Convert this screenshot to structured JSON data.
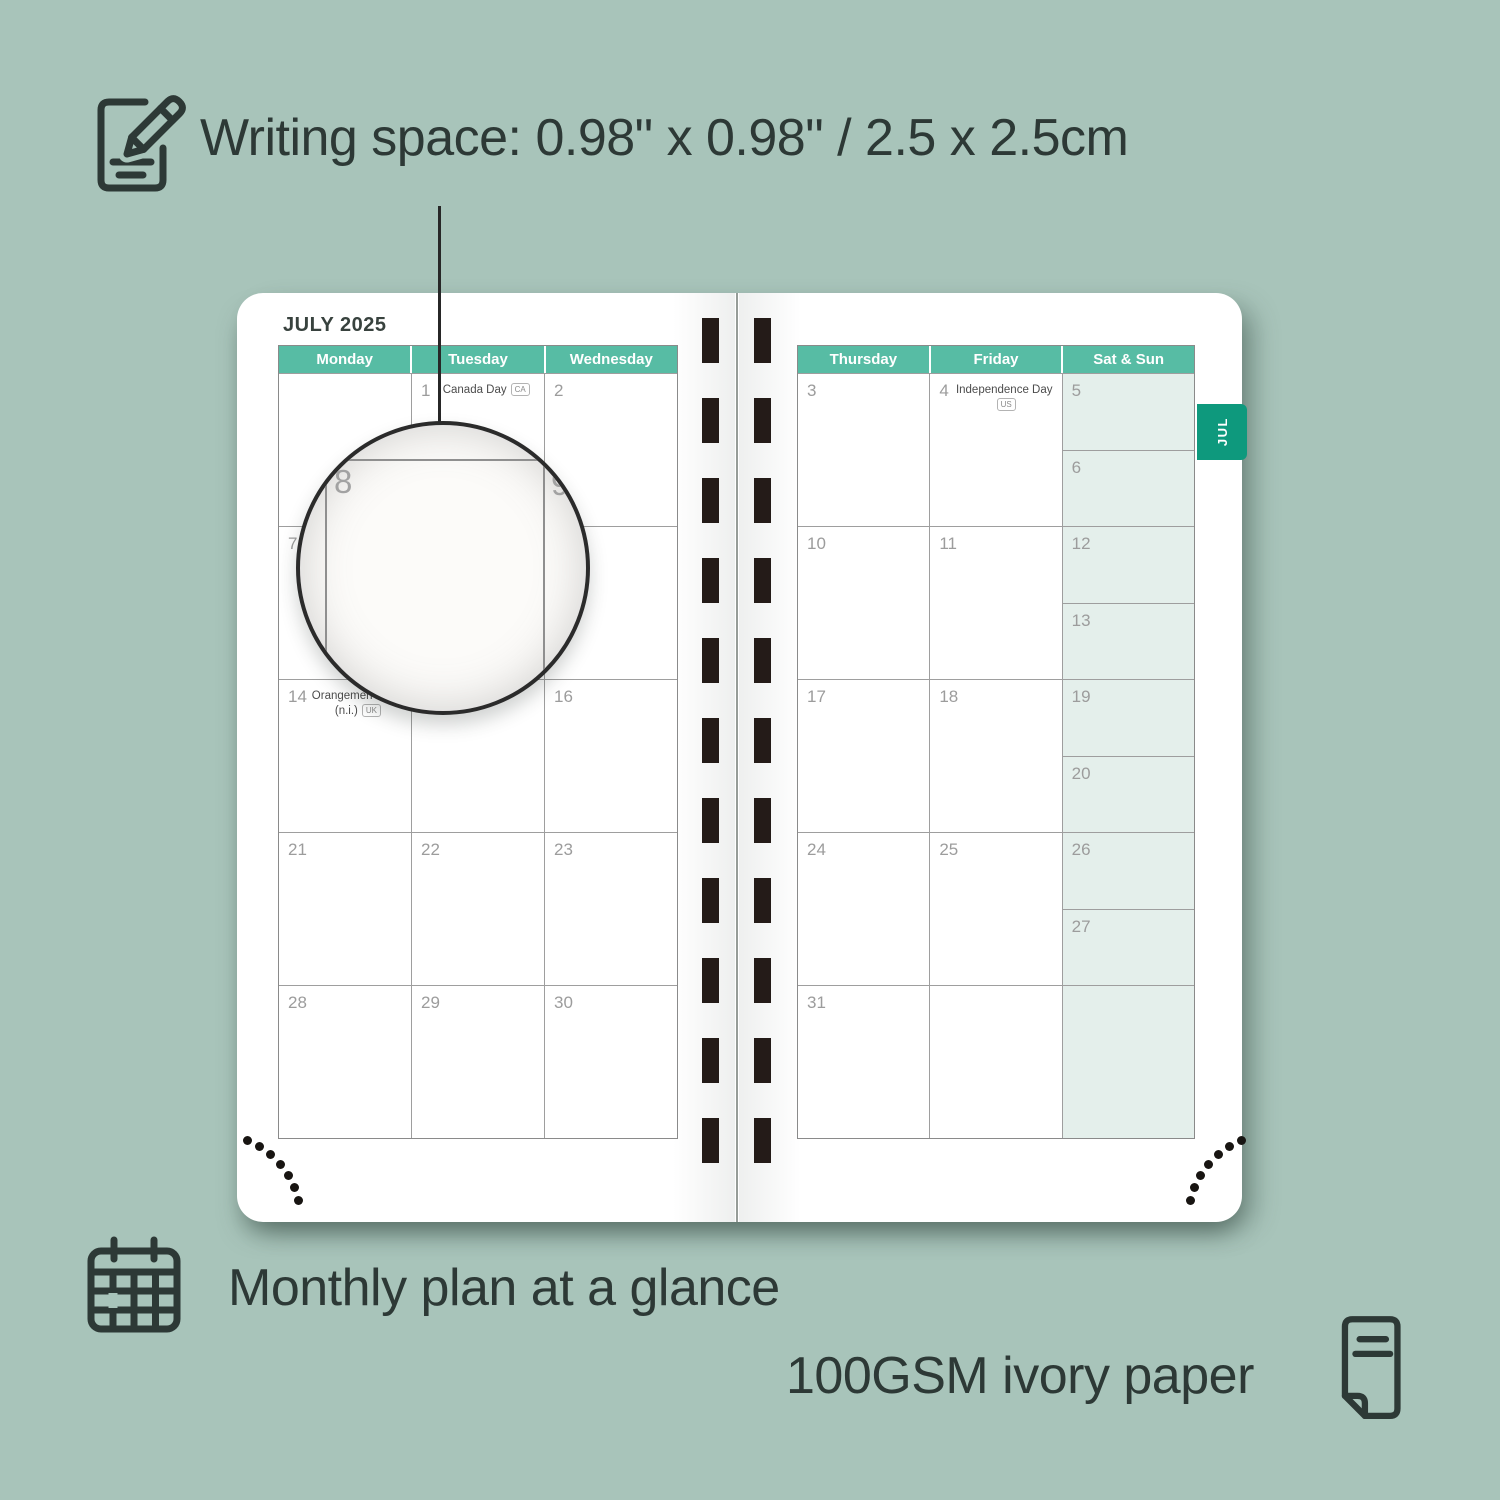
{
  "annotations": {
    "writing_space": "Writing space: 0.98\" x 0.98\" / 2.5 x 2.5cm",
    "monthly_plan": "Monthly plan at a glance",
    "paper": "100GSM ivory paper"
  },
  "planner": {
    "month_title": "JULY 2025",
    "tab_label": "JUL",
    "magnifier": {
      "cell_number": "8",
      "adjacent_number": "9"
    },
    "left_page": {
      "headers": [
        "Monday",
        "Tuesday",
        "Wednesday"
      ],
      "rows": [
        [
          {
            "n": ""
          },
          {
            "n": "1",
            "holiday": {
              "name": "Canada Day",
              "badge": "CA"
            }
          },
          {
            "n": "2"
          }
        ],
        [
          {
            "n": "7"
          },
          {
            "n": "8"
          },
          {
            "n": "9"
          }
        ],
        [
          {
            "n": "14",
            "holiday": {
              "name": "Orangemen's Day",
              "name2": "(n.i.)",
              "badge": "UK"
            }
          },
          {
            "n": "15"
          },
          {
            "n": "16"
          }
        ],
        [
          {
            "n": "21"
          },
          {
            "n": "22"
          },
          {
            "n": "23"
          }
        ],
        [
          {
            "n": "28"
          },
          {
            "n": "29"
          },
          {
            "n": "30"
          }
        ]
      ]
    },
    "right_page": {
      "headers": [
        "Thursday",
        "Friday",
        "Sat & Sun"
      ],
      "rows": [
        [
          {
            "n": "3"
          },
          {
            "n": "4",
            "holiday": {
              "name": "Independence Day",
              "badge": "US"
            }
          },
          {
            "split": [
              {
                "n": "5"
              },
              {
                "n": "6"
              }
            ]
          }
        ],
        [
          {
            "n": "10"
          },
          {
            "n": "11"
          },
          {
            "split": [
              {
                "n": "12"
              },
              {
                "n": "13"
              }
            ]
          }
        ],
        [
          {
            "n": "17"
          },
          {
            "n": "18"
          },
          {
            "split": [
              {
                "n": "19"
              },
              {
                "n": "20"
              }
            ]
          }
        ],
        [
          {
            "n": "24"
          },
          {
            "n": "25"
          },
          {
            "split": [
              {
                "n": "26"
              },
              {
                "n": "27"
              }
            ]
          }
        ],
        [
          {
            "n": "31"
          },
          {
            "n": ""
          },
          {
            "shaded": true,
            "n": ""
          }
        ]
      ]
    }
  },
  "colors": {
    "background": "#a8c4ba",
    "header_teal": "#57bca4",
    "tab_teal": "#0e997d",
    "weekend_fill": "#e4efeb",
    "ink": "#2d3936",
    "binding": "#241b18"
  }
}
